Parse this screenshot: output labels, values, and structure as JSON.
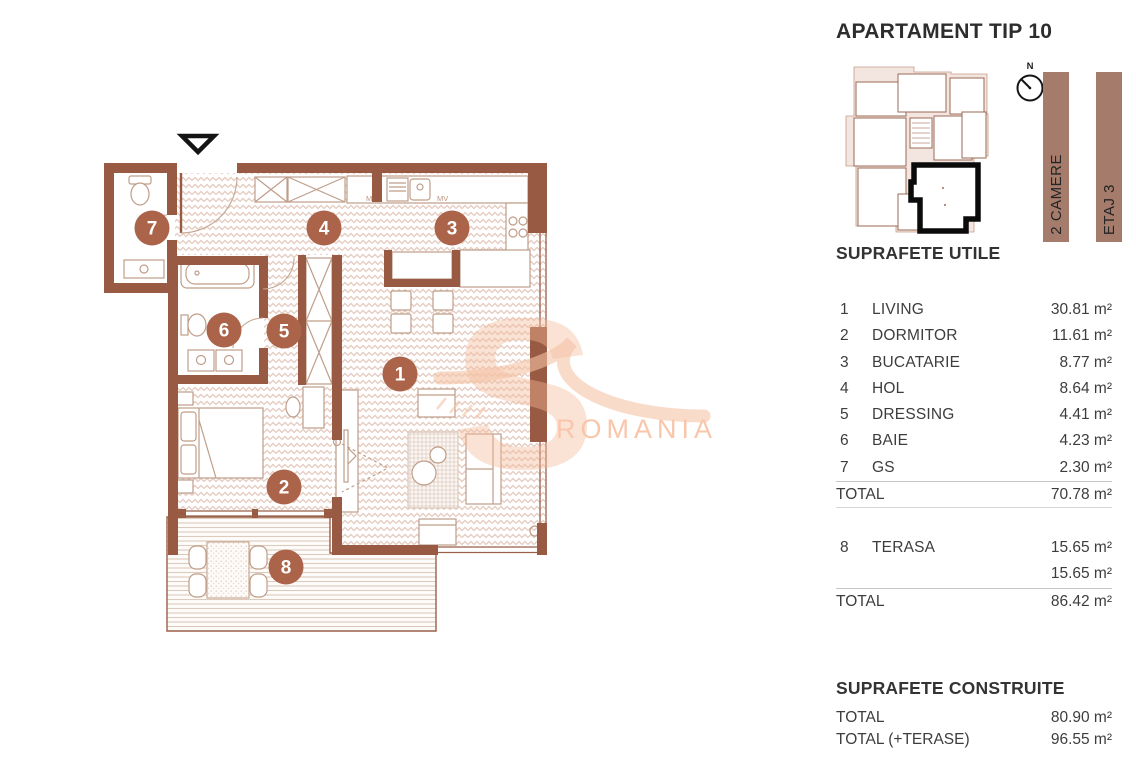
{
  "header": {
    "title": "APARTAMENT TIP 10"
  },
  "sidebar": {
    "compass_label": "N",
    "bars": [
      {
        "label": "2 CAMERE"
      },
      {
        "label": "ETAJ 3"
      }
    ]
  },
  "suprafete_utile": {
    "heading": "SUPRAFETE UTILE",
    "rows": [
      {
        "num": "1",
        "name": "LIVING",
        "area": "30.81 m²"
      },
      {
        "num": "2",
        "name": "DORMITOR",
        "area": "11.61 m²"
      },
      {
        "num": "3",
        "name": "BUCATARIE",
        "area": "8.77 m²"
      },
      {
        "num": "4",
        "name": "HOL",
        "area": "8.64 m²"
      },
      {
        "num": "5",
        "name": "DRESSING",
        "area": "4.41 m²"
      },
      {
        "num": "6",
        "name": "BAIE",
        "area": "4.23 m²"
      },
      {
        "num": "7",
        "name": "GS",
        "area": "2.30 m²"
      }
    ],
    "total": {
      "label": "TOTAL",
      "value": "70.78 m²"
    }
  },
  "terase": {
    "rows": [
      {
        "num": "8",
        "name": "TERASA",
        "area": "15.65 m²"
      },
      {
        "num": "",
        "name": "",
        "area": "15.65 m²"
      }
    ],
    "total": {
      "label": "TOTAL",
      "value": "86.42 m²"
    }
  },
  "suprafete_construite": {
    "heading": "SUPRAFETE CONSTRUITE",
    "rows": [
      {
        "label": "TOTAL",
        "value": "80.90 m²"
      },
      {
        "label": "TOTAL (+TERASE)",
        "value": "96.55 m²"
      }
    ]
  },
  "plan": {
    "badges": [
      "1",
      "2",
      "3",
      "4",
      "5",
      "6",
      "7",
      "8"
    ],
    "labels": {
      "m": "M",
      "mv": "MV"
    },
    "watermark": "ROMANIA",
    "colors": {
      "wall": "#985a42",
      "badge": "#ab6349",
      "bar": "#a57c6b",
      "watermark": "#f8c7ac"
    }
  }
}
